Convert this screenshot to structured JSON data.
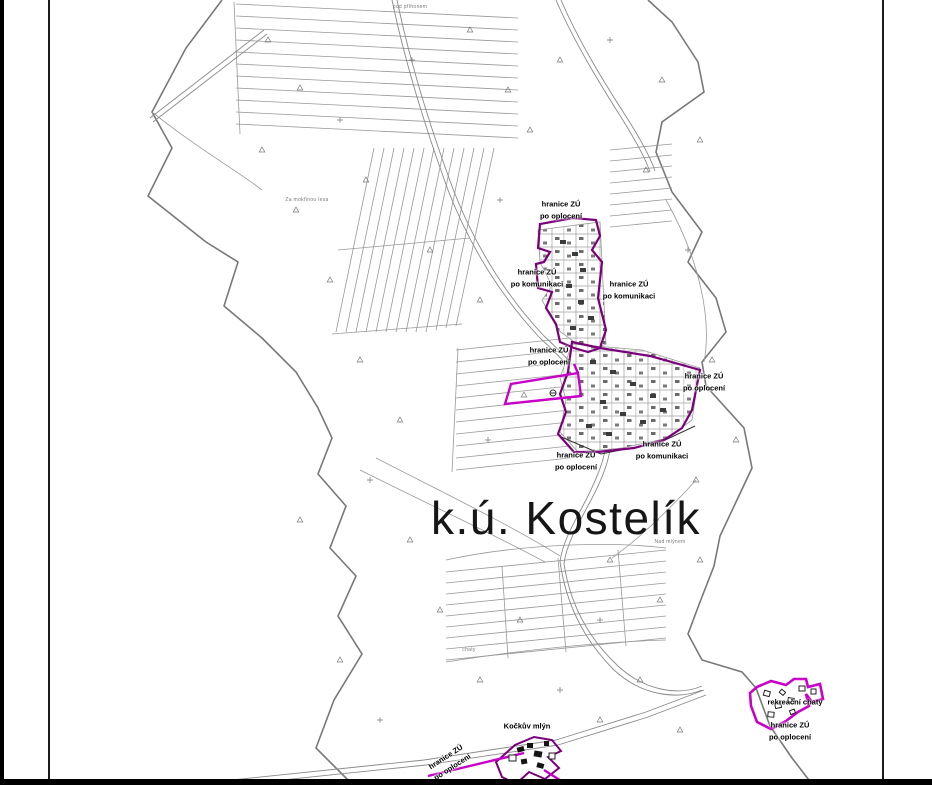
{
  "map": {
    "title": "k.ú. Kostelík",
    "boundary_labels": [
      {
        "line1": "hranice ZÚ",
        "line2": "po oplocení"
      },
      {
        "line1": "hranice ZÚ",
        "line2": "po komunikaci"
      },
      {
        "line1": "hranice ZÚ",
        "line2": "po komunikaci"
      },
      {
        "line1": "hranice ZÚ",
        "line2": "po oplocení"
      },
      {
        "line1": "hranice ZÚ",
        "line2": "po oplocení"
      },
      {
        "line1": "hranice ZÚ",
        "line2": "po komunikaci"
      },
      {
        "line1": "hranice ZÚ",
        "line2": "po oplocení"
      },
      {
        "line1": "hranice ZÚ",
        "line2": "po oplocení"
      },
      {
        "line1": "hranice ZÚ",
        "line2": "po oplocení"
      }
    ],
    "point_labels": [
      {
        "text": "rekreační chaty"
      },
      {
        "text": "Kočkův mlýn"
      }
    ],
    "field_names": [
      "Za mokřinou lesa",
      "pod příhonem",
      "Nad mlýnem",
      "chaty"
    ],
    "colors": {
      "zu_boundary_dark": "#7A007A",
      "zu_boundary_magenta": "#C800C8",
      "parcel_line": "#8a8a8a",
      "territory_line": "#787878",
      "frame": "#000000"
    }
  }
}
